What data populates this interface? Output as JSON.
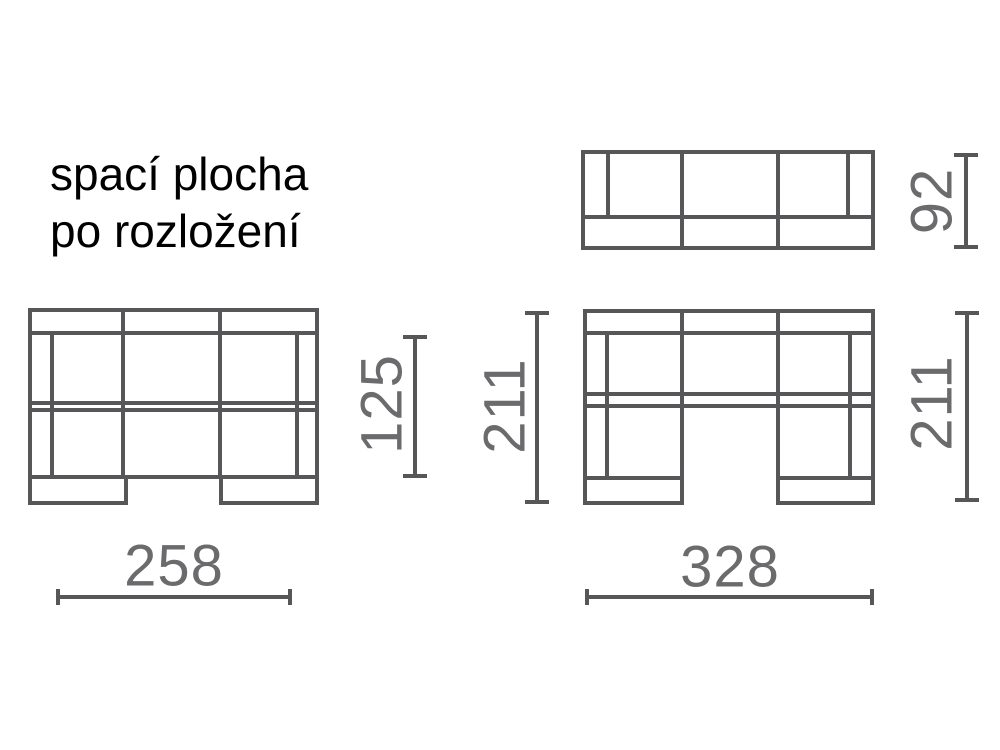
{
  "title": {
    "line1": "spací plocha",
    "line2": "po rozložení"
  },
  "colors": {
    "background": "#ffffff",
    "outline": "#57575a",
    "dimension_line": "#57575a",
    "dimension_text": "#6b6b6e",
    "title_text": "#000000"
  },
  "views": {
    "folded_top_view": {
      "depth_label": "92"
    },
    "unfolded_bed_top_view": {
      "width_label": "258",
      "depth_label": "125"
    },
    "sectional_top_view": {
      "width_label": "328",
      "left_depth_label": "211",
      "right_depth_label": "211"
    }
  }
}
